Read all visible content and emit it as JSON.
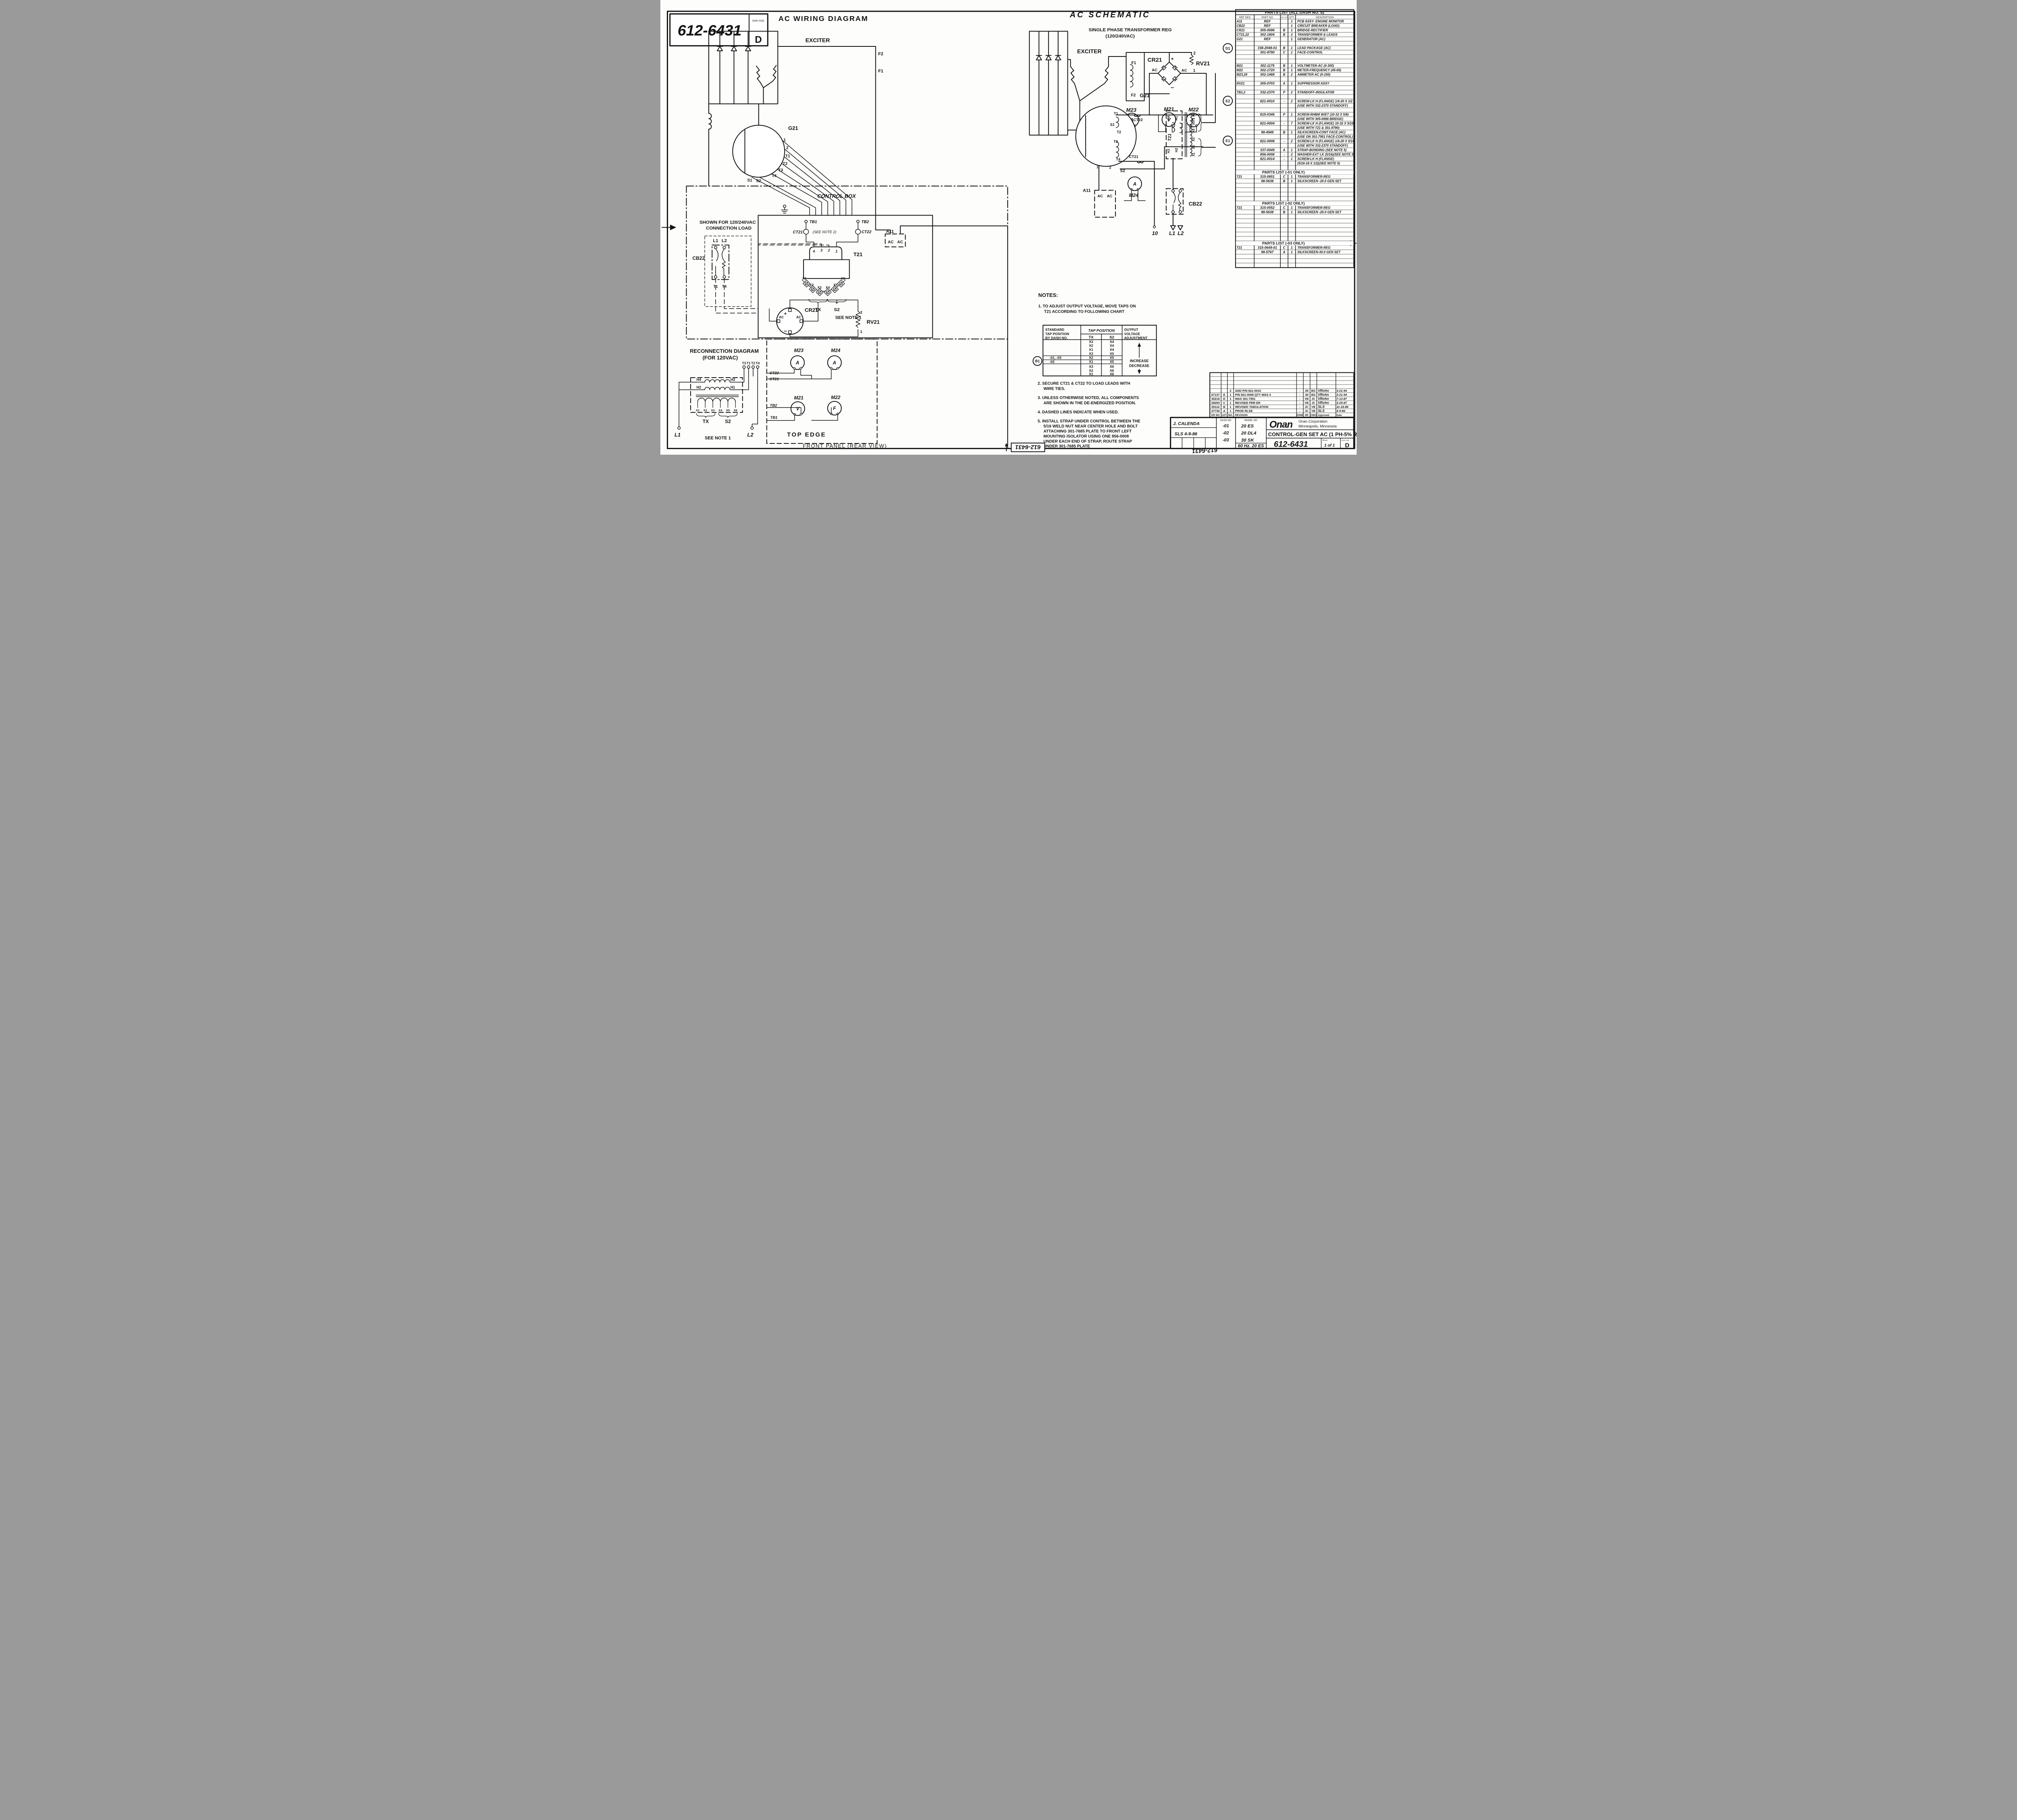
{
  "sheet": {
    "number": "612-6431",
    "dwg_size_label": "DWG SIZE",
    "dwg_size": "D",
    "stamp": "612-6431"
  },
  "zones": {
    "d1": "D1",
    "e2": "E2",
    "e1": "E1",
    "b1": "B1"
  },
  "wiring": {
    "title": "AC WIRING DIAGRAM",
    "exciter": "EXCITER",
    "f2": "F2",
    "f1": "F1",
    "g21": "G21",
    "leads": [
      "1",
      "2",
      "T1",
      "T2",
      "T3",
      "T4",
      "S1",
      "S2"
    ],
    "control_box": "CONTROL BOX",
    "shown1": "SHOWN FOR 120/240VAC",
    "shown2": "CONNECTION LOAD",
    "l1": "L1",
    "l2": "L2",
    "cb22": "CB22",
    "t1": "T1",
    "t4": "T4",
    "tb1": "TB1",
    "tb2": "TB2",
    "ct21": "CT21",
    "ct21_note": "(SEE NOTE 2)",
    "ct22": "CT22",
    "t21": "T21",
    "taps": [
      "4",
      "3",
      "2",
      "1"
    ],
    "xterms": [
      "X1",
      "X2",
      "X3",
      "X4",
      "X5",
      "X6"
    ],
    "tx": "TX",
    "s2b": "S2",
    "see_note1": "SEE NOTE 1",
    "cr21": "CR21",
    "plus": "+",
    "minus": "−",
    "ac": "AC",
    "rv21": "RV21",
    "rv2": "2",
    "rv1": "1",
    "a11": "A11",
    "recon1": "RECONNECTION DIAGRAM",
    "recon2": "(FOR 120VAC)",
    "rterms": [
      "T3",
      "T1",
      "T2",
      "T4"
    ],
    "h4": "H4",
    "h3": "H3",
    "h2": "H2",
    "h1": "H1",
    "panel": {
      "m23": "M23",
      "m24": "M24",
      "m21": "M21",
      "m22": "M22",
      "a": "A",
      "v": "V",
      "f": "F",
      "ct22": "CT22",
      "ct21": "CT21",
      "tb2": "TB2",
      "tb1": "TB1",
      "top_edge": "TOP EDGE",
      "front_panel": "FRONT PANEL (REAR VIEW)"
    }
  },
  "schematic": {
    "title": "AC SCHEMATIC",
    "sub1": "SINGLE PHASE TRANSFORMER REG",
    "sub2": "(120/240VAC)",
    "exciter": "EXCITER",
    "f1": "F1",
    "f2": "F2",
    "cr21": "CR21",
    "plus": "+",
    "minus": "−",
    "ac": "AC",
    "rv21": "RV21",
    "rv2": "2",
    "rv1": "1",
    "m23": "M23",
    "m21": "M21",
    "m22": "M22",
    "m24": "M24",
    "a": "A",
    "v": "V",
    "f": "F",
    "g21": "G21",
    "t1": "T1",
    "s1": "S1",
    "t2": "T2",
    "t3": "T3",
    "t4": "T4",
    "n1": "1",
    "n2": "2",
    "s2": "S2",
    "ct22": "CT22",
    "ct21": "CT21",
    "t21": "T21",
    "h4": "H4",
    "h1": "H1",
    "h3": "H3",
    "h2": "H2",
    "xwind": [
      "X6",
      "X5",
      "X4",
      "X3",
      "X2",
      "X1"
    ],
    "a11": "A11",
    "cb22": "CB22",
    "out10": "10",
    "l1": "L1",
    "l2": "L2"
  },
  "notes": {
    "heading": "NOTES:",
    "n1": [
      "1. TO ADJUST OUTPUT VOLTAGE, MOVE TAPS ON",
      "T21 ACCORDING TO FOLLOWING CHART"
    ],
    "chart": {
      "h1a": "STANDARD",
      "h1b": "TAP POSITION",
      "h1c": "BY DASH NO.",
      "h2": "TAP POSITION",
      "tx": "TX",
      "s2": "S2",
      "h3a": "OUTPUT",
      "h3b": "VOLTAGE",
      "h3c": "ADJUSTMENT",
      "increase": "INCREASE",
      "decrease": "DECREASE",
      "rows": [
        {
          "dash": "",
          "tx": "X3",
          "s2": "X4"
        },
        {
          "dash": "",
          "tx": "X2",
          "s2": "X4"
        },
        {
          "dash": "",
          "tx": "X1",
          "s2": "X4"
        },
        {
          "dash": "",
          "tx": "X3",
          "s2": "X5"
        },
        {
          "dash": "-01, -03",
          "tx": "X2",
          "s2": "X5"
        },
        {
          "dash": "-02",
          "tx": "X1",
          "s2": "X5"
        },
        {
          "dash": "",
          "tx": "X3",
          "s2": "X6"
        },
        {
          "dash": "",
          "tx": "X2",
          "s2": "X6"
        },
        {
          "dash": "",
          "tx": "X1",
          "s2": "X6"
        }
      ]
    },
    "n2": [
      "2. SECURE CT21 & CT22 TO LOAD LEADS WITH",
      "WIRE TIES."
    ],
    "n3": [
      "3. UNLESS OTHERWISE NOTED, ALL COMPONENTS",
      "ARE SHOWN IN THE DE-ENERGIZED POSITION."
    ],
    "n4": [
      "4. DASHED LINES INDICATE WHEN USED."
    ],
    "n5": [
      "5. INSTALL STRAP UNDER CONTROL BETWEEN THE",
      "5/16 WELD NUT NEAR CENTER HOLE AND BOLT",
      "ATTACHING 301-7685 PLATE TO FRONT LEFT",
      "MOUNTING ISOLATOR USING ONE 856-0008",
      "UNDER EACH END OF STRAP, ROUTE STRAP",
      "UNDER 301-7685 PLATE"
    ]
  },
  "parts_all": {
    "title": "PARTS LIST (ALL DASH NO.'S)",
    "h": [
      "REF DES",
      "PART NO",
      "DWG SIZE",
      "QTY",
      "DESCRIPTION"
    ],
    "rows": [
      {
        "ref": "A11",
        "part": "REF",
        "qty": "1",
        "desc": "PCB ASSY- ENGINE MONITOR"
      },
      {
        "ref": "CB22",
        "part": "REF",
        "qty": "1",
        "desc": "CIRCUIT BREAKER (LOAD)"
      },
      {
        "ref": "CR21",
        "part": "305-0696",
        "size": "B",
        "qty": "1",
        "desc": "BRIDGE-RECTIFIER"
      },
      {
        "ref": "CT21,22",
        "part": "302-1804",
        "size": "B",
        "qty": "2",
        "desc": "TRANSFORMER & LEADS"
      },
      {
        "ref": "G21",
        "part": "REF",
        "qty": "1",
        "desc": "GENERATOR (AC)"
      },
      {},
      {
        "part": "338-2048-01",
        "size": "B",
        "qty": "1",
        "desc": "LEAD PACKAGE (AC)"
      },
      {
        "part": "301-9790",
        "size": "C",
        "qty": "1",
        "desc": "FACE-CONTROL"
      },
      {},
      {},
      {
        "ref": "M21",
        "part": "302-1175",
        "size": "B",
        "qty": "1",
        "desc": "VOLTMETER-AC (0-300)"
      },
      {
        "ref": "M22",
        "part": "302-1720",
        "size": "B",
        "qty": "1",
        "desc": "METER-FREQUENCY (45-65)"
      },
      {
        "ref": "M23,24",
        "part": "302-1468",
        "size": "B",
        "qty": "2",
        "desc": "AMMETER AC (0-150)"
      },
      {},
      {
        "ref": "RV21",
        "part": "305-0703",
        "size": "A",
        "qty": "1",
        "desc": "SUPPRESSOR ASSY"
      },
      {},
      {
        "ref": "TB1,2",
        "part": "332-2370",
        "size": "P",
        "qty": "2",
        "desc": "STANDOFF-INSULATOR"
      },
      {},
      {
        "part": "821-0010",
        "size": "-",
        "qty": "2",
        "desc": "SCREW-LK H (FLANGE) 1/4-20 X 1/2"
      },
      {
        "desc": "(USE WITH 332-2370 STANDOFF)"
      },
      {},
      {
        "part": "815-0346",
        "size": "P",
        "qty": "1",
        "desc": "SCREW-RHBM W/ET (10-32 X 5/8)"
      },
      {
        "desc": "(USE WITH 305-0696 BRIDGE)"
      },
      {
        "part": "821-0004",
        "size": "-",
        "qty": "7",
        "desc": "SCREW-LK H (FLANGE) 10-32 X 5/16"
      },
      {
        "desc": "(USE WITH T21 & 301-9790)"
      },
      {
        "part": "98-4948",
        "size": "B",
        "qty": "1",
        "desc": "SILKSCREEN-CONT FACE (AC)"
      },
      {
        "desc": "(USE ON 301-7951 FACE-CONTROL)"
      },
      {
        "part": "821-0008",
        "size": "-",
        "qty": "2",
        "desc": "SCREW-LK H (FLANGE) 1/4-20 X 5/16"
      },
      {
        "desc": "(USE WITH 332-2370 STANDOFF)"
      },
      {
        "part": "337-0049",
        "size": "A",
        "qty": "1",
        "desc": "STRAP-BONDING (SEE NOTE 5)"
      },
      {
        "part": "856-0008",
        "size": "-",
        "qty": "2",
        "desc": "WASHER-EXT LK (5/16)(SEE NOTE 5)"
      },
      {
        "part": "821-0014",
        "size": "-",
        "qty": "1",
        "desc": "SCREW-LK H (FLANGE)"
      },
      {
        "desc": "(5/16-18 X 1/2)(SEE NOTE 5)"
      }
    ]
  },
  "parts_01": {
    "title": "PARTS LIST (-01 ONLY)",
    "rows": [
      {
        "ref": "T21",
        "part": "315-0651",
        "size": "C",
        "qty": "1",
        "desc": "TRANSFORMER-REG"
      },
      {
        "part": "98-5638",
        "size": "B",
        "qty": "1",
        "desc": "SILKSCREEN -20.0 GEN SET"
      }
    ]
  },
  "parts_02": {
    "title": "PARTS LIST (-02 ONLY)",
    "rows": [
      {
        "ref": "T21",
        "part": "315-0552",
        "size": "C",
        "qty": "1",
        "desc": "TRANSFORMER-REG"
      },
      {
        "part": "98-5638",
        "size": "B",
        "qty": "1",
        "desc": "SILKSCREEN -20.0 GEN SET"
      }
    ]
  },
  "parts_03": {
    "title": "PARTS LIST (-03 ONLY)",
    "rows": [
      {
        "ref": "T21",
        "part": "315-0649-01",
        "size": "C",
        "qty": "1",
        "desc": "TRANSFORMER-REG"
      },
      {
        "part": "98-5767",
        "size": "A",
        "qty": "1",
        "desc": "SILKSCREEN-30.0 GEN SET"
      }
    ]
  },
  "revisions": {
    "h": [
      "ER NO",
      "LET",
      "NO.",
      "REVISION",
      "ZONE",
      "DR",
      "CHKD",
      "Approved",
      "Date"
    ],
    "rows": [
      {
        "er": "",
        "let": "",
        "no": "2",
        "rev": "ADD P/N 821-0010",
        "zone": "-",
        "dr": "JN",
        "chk": "BG",
        "app": "VRohn",
        "date": "3-21-94"
      },
      {
        "er": "67137",
        "let": "E",
        "no": "1",
        "rev": "P/N 821-0008 QTY WAS 4",
        "zone": "-",
        "dr": "JN",
        "chk": "BG",
        "app": "VRohn",
        "date": "3-21-94"
      },
      {
        "er": "30218",
        "let": "D",
        "no": "1",
        "rev": "WAS 301-7951",
        "zone": "-",
        "dr": "VB",
        "chk": "JC",
        "app": "VRohn",
        "date": "7-13-87"
      },
      {
        "er": "29293",
        "let": "C",
        "no": "1",
        "rev": "REVISED PER ER",
        "zone": "-",
        "dr": "VB",
        "chk": "JC",
        "app": "VRohn",
        "date": "3-25-87"
      },
      {
        "er": "29112",
        "let": "B",
        "no": "1",
        "rev": "REVISED TABULATION",
        "zone": "-",
        "dr": "JC",
        "chk": "VB",
        "app": "SLS",
        "date": "11-18-86"
      },
      {
        "er": "27736",
        "let": "A",
        "no": "1",
        "rev": "PROD RLSE",
        "zone": "-",
        "dr": "JC",
        "chk": "VB",
        "app": "SLS",
        "date": "4-9-86"
      }
    ]
  },
  "title_block": {
    "drawn": "J. CALENDA",
    "checked": "SLS 4-9-86",
    "dash_label": "DASH NO",
    "model_label": "MODEL NO",
    "dashes": [
      "-01",
      "-02",
      "-03"
    ],
    "models": [
      "20 ES",
      "20 DL4",
      "30 SK"
    ],
    "freq": "60 Hz. 20 ES",
    "logo": "Onan",
    "company1": "Onan Corporation",
    "company2": "Minneapolis, Minnesota",
    "title": "CONTROL-GEN SET AC (1 PH-5% REG)",
    "dwg_no": "612-6431",
    "sheet_label": "Sheet",
    "sheet": "1 of 1",
    "size": "D"
  }
}
